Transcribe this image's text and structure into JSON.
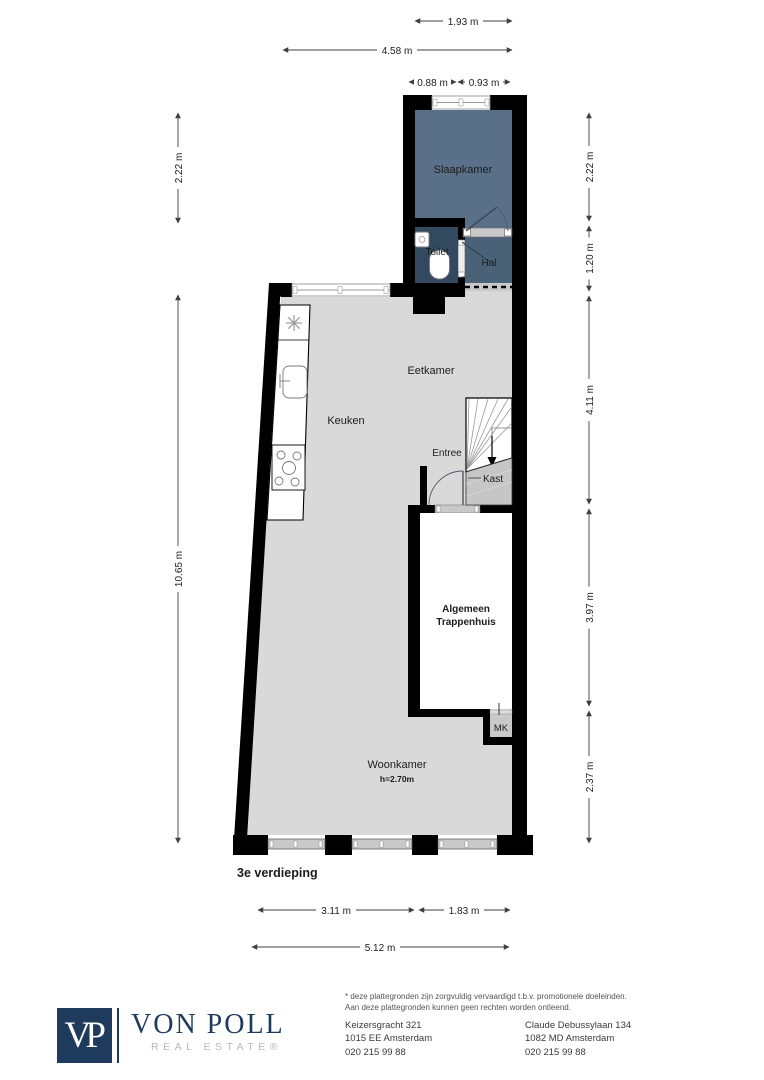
{
  "plan": {
    "floor_label": "3e verdieping",
    "rooms": {
      "slaapkamer": "Slaapkamer",
      "toilet": "Toilet",
      "hal": "Hal",
      "eetkamer": "Eetkamer",
      "keuken": "Keuken",
      "entree": "Entree",
      "kast": "Kast",
      "trappenhuis_line1": "Algemeen",
      "trappenhuis_line2": "Trappenhuis",
      "mk": "MK",
      "woonkamer": "Woonkamer",
      "woonkamer_ceiling_height": "h=2.70m"
    },
    "dimensions": {
      "top_inner": "1.93 m",
      "top_outer": "4.58 m",
      "top_window_left": "0.88 m",
      "top_window_right": "0.93 m",
      "left_upper": "2.22 m",
      "left_main": "10.65 m",
      "right_1": "2.22 m",
      "right_2": "1.20 m",
      "right_3": "4.11 m",
      "right_4": "3.97 m",
      "right_5": "2.37 m",
      "bottom_left": "3.11 m",
      "bottom_right": "1.83 m",
      "bottom_total": "5.12 m"
    },
    "colors": {
      "wall": "#000000",
      "floor": "#d9d9da",
      "bedroom_fill": "#5a7089",
      "hall_fill": "#4a6278",
      "toilet_fill": "#33495f",
      "closet_fill": "#c6c6c6"
    }
  },
  "footer": {
    "logo_initials": "VP",
    "brand_name": "VON POLL",
    "brand_subtitle": "REAL ESTATE®",
    "brand_color": "#1e3a5c",
    "disclaimer_line1": "* deze plattegronden zijn zorgvuldig vervaardigd t.b.v. promotionele doeleinden.",
    "disclaimer_line2": "Aan deze plattegronden kunnen geen rechten worden ontleend.",
    "office_1": {
      "address": "Keizersgracht 321",
      "city": "1015 EE Amsterdam",
      "phone": "020 215 99 88"
    },
    "office_2": {
      "address": "Claude Debussylaan 134",
      "city": "1082 MD Amsterdam",
      "phone": "020 215 99 88"
    }
  }
}
